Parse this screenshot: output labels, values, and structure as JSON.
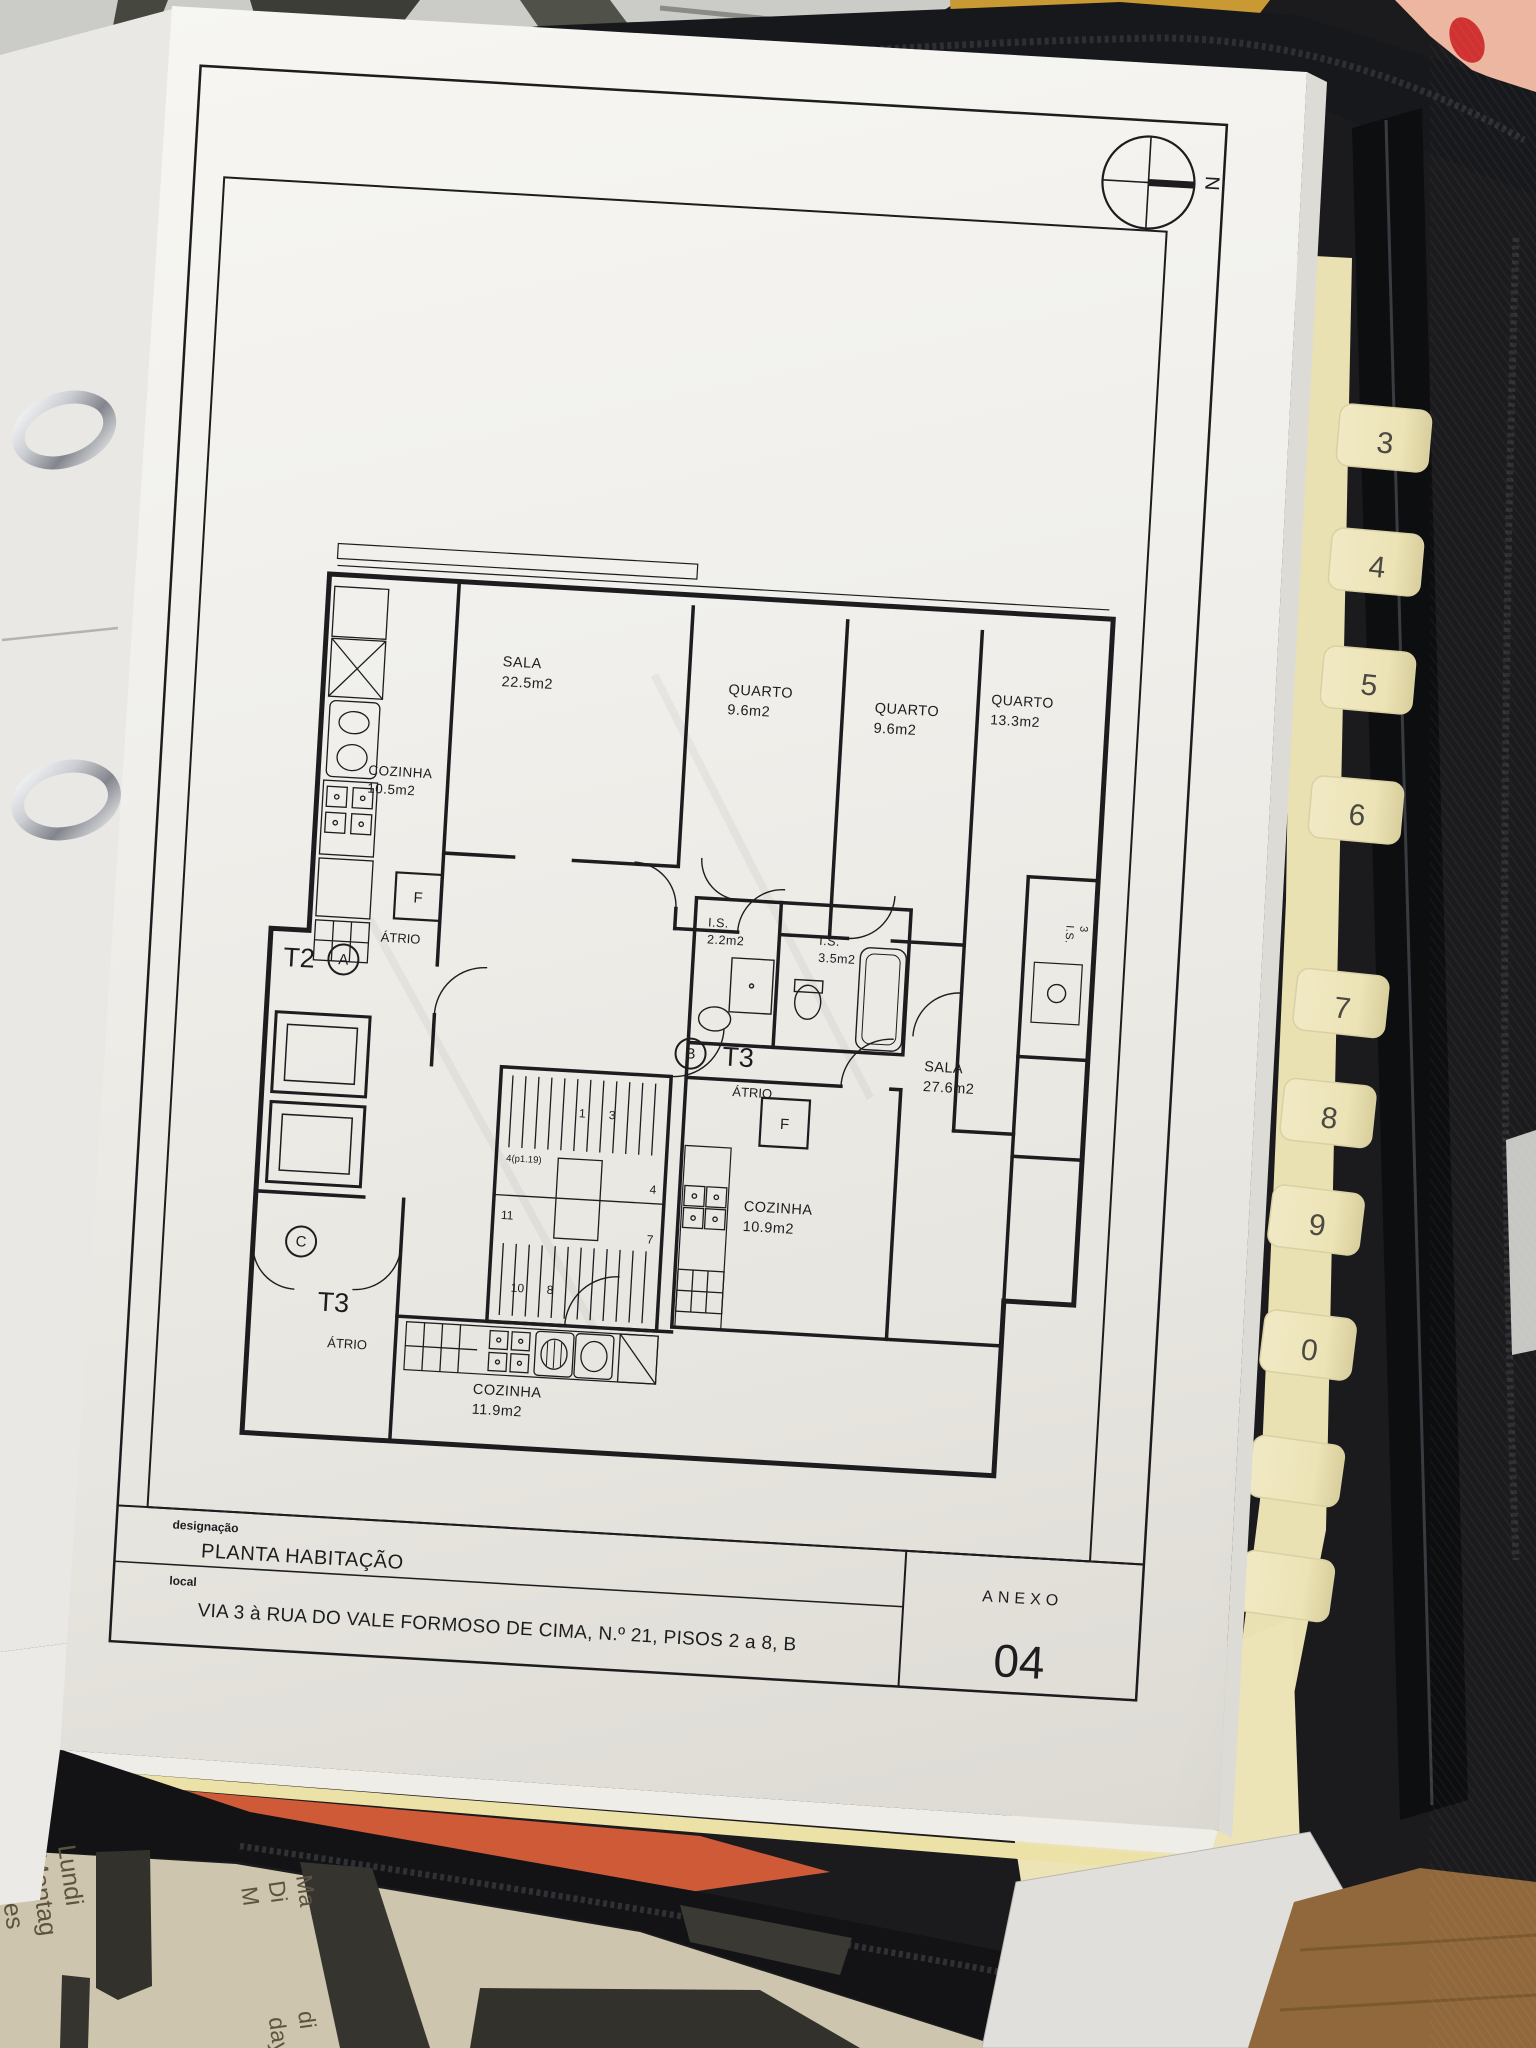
{
  "plan": {
    "compass_n": "N",
    "rooms": {
      "sala_t2": {
        "name": "SALA",
        "area": "22.5m2"
      },
      "quarto_1": {
        "name": "QUARTO",
        "area": "9.6m2"
      },
      "quarto_2": {
        "name": "QUARTO",
        "area": "9.6m2"
      },
      "quarto_3": {
        "name": "QUARTO",
        "area": "13.3m2"
      },
      "cozinha_t2": {
        "name": "COZINHA",
        "area": "10.5m2"
      },
      "is_1": {
        "name": "I.S.",
        "area": "2.2m2"
      },
      "is_2": {
        "name": "I.S.",
        "area": "3.5m2"
      },
      "sala_t3": {
        "name": "SALA",
        "area": "27.6m2"
      },
      "cozinha_t3b": {
        "name": "COZINHA",
        "area": "10.9m2"
      },
      "cozinha_t3c": {
        "name": "COZINHA",
        "area": "11.9m2"
      },
      "is_shaft": {
        "name": "I.S.",
        "area": "3"
      }
    },
    "units": {
      "t2": {
        "type": "T2",
        "letter": "A",
        "atrio": "ÁTRIO"
      },
      "t3b": {
        "type": "T3",
        "letter": "B",
        "atrio": "ÁTRIO"
      },
      "t3c": {
        "type": "T3",
        "letter": "C",
        "atrio": "ÁTRIO"
      }
    },
    "fridge_label": "F",
    "stair_numbers": {
      "s1": "1",
      "s3": "3",
      "sp": "4(p1.19)",
      "s11": "11",
      "s4": "4",
      "s7": "7",
      "s10": "10",
      "s8": "8"
    },
    "title_block": {
      "designacao_label": "designação",
      "designacao": "PLANTA HABITAÇÃO",
      "local_label": "local",
      "local": "VIA 3 à RUA DO VALE FORMOSO DE CIMA, N.º 21, PISOS 2 a 8, B",
      "anexo_label": "ANEXO",
      "anexo_number": "04"
    }
  },
  "binder": {
    "tab_labels": [
      "3",
      "4",
      "5",
      "6",
      "7",
      "8",
      "9",
      "0"
    ]
  },
  "surroundings": {
    "calendar_left": [
      "Lundi",
      "Montag",
      "Lunes"
    ],
    "calendar_mid": [
      "Ma",
      "Di",
      "M"
    ],
    "calendar_bottom": [
      "di",
      "day"
    ]
  }
}
